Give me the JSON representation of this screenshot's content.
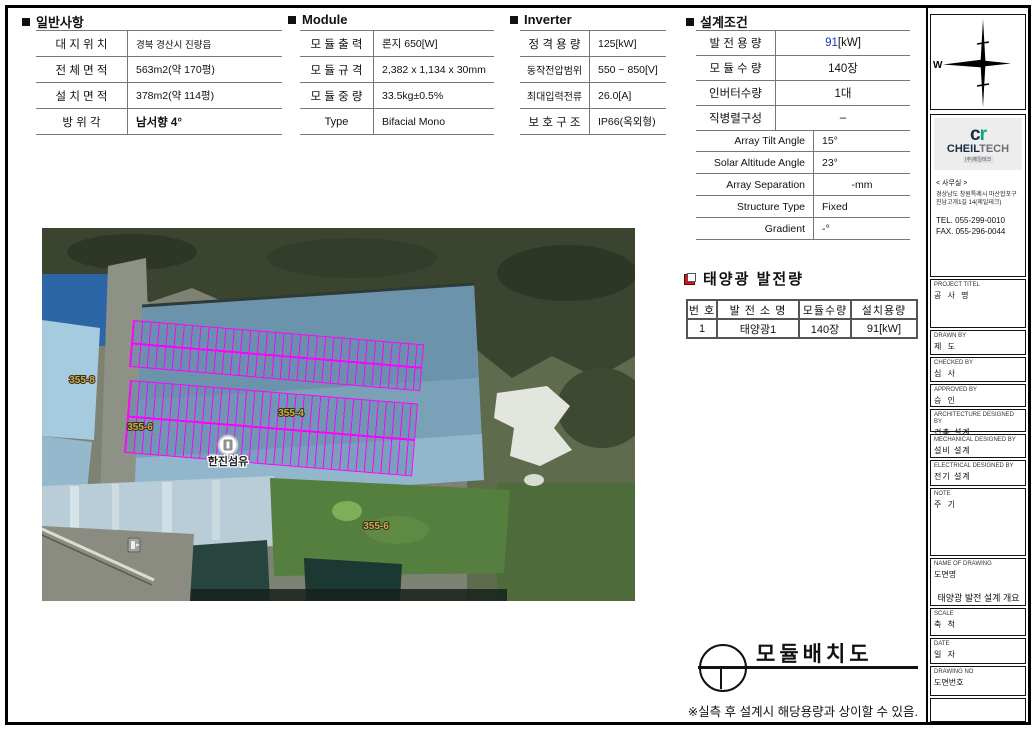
{
  "general": {
    "title": "일반사항",
    "rows": [
      {
        "label": "대 지 위 치",
        "value": "경북 경산시 진량읍"
      },
      {
        "label": "전 체 면 적",
        "value": "563m2(약 170평)"
      },
      {
        "label": "설 치 면 적",
        "value": "378m2(약 114평)"
      },
      {
        "label": "방 위 각",
        "value": "남서향 4°"
      }
    ]
  },
  "module": {
    "title": "Module",
    "rows": [
      {
        "label": "모 듈 출 력",
        "value": "론지 650[W]"
      },
      {
        "label": "모 듈 규 격",
        "value": "2,382 x 1,134 x 30mm"
      },
      {
        "label": "모 듈 중 량",
        "value": "33.5kg±0.5%"
      },
      {
        "label": "Type",
        "value": "Bifacial Mono"
      }
    ]
  },
  "inverter": {
    "title": "Inverter",
    "rows": [
      {
        "label": "정 격 용 량",
        "value": "125[kW]"
      },
      {
        "label": "동작전압범위",
        "value": "550 ~ 850[V]"
      },
      {
        "label": "최대입력전류",
        "value": "26.0[A]"
      },
      {
        "label": "보 호 구 조",
        "value": "IP66(옥외형)"
      }
    ]
  },
  "design": {
    "title": "설계조건",
    "rows_kr": [
      {
        "label": "발 전 용 량",
        "value_primary": "91",
        "value_suffix": "[kW]",
        "primary_color": "#1436c8"
      },
      {
        "label": "모 듈 수 량",
        "value": "140장"
      },
      {
        "label": "인버터수량",
        "value": "1대"
      },
      {
        "label": "직병렬구성",
        "value": "–"
      }
    ],
    "rows_en": [
      {
        "label": "Array Tilt Angle",
        "value": "15°"
      },
      {
        "label": "Solar Altitude Angle",
        "value": "23°"
      },
      {
        "label": "Array Separation",
        "value": "-mm"
      },
      {
        "label": "Structure Type",
        "value": "Fixed"
      },
      {
        "label": "Gradient",
        "value": "-°"
      }
    ]
  },
  "generation": {
    "title": "태양광 발전량",
    "headers": [
      "번 호",
      "발 전 소 명",
      "모듈수량",
      "설치용량"
    ],
    "rows": [
      [
        "1",
        "태양광1",
        "140장",
        "91[kW]"
      ]
    ]
  },
  "map": {
    "parcel_labels": [
      {
        "text": "355-8"
      },
      {
        "text": "355-6"
      },
      {
        "text": "355-4"
      },
      {
        "text": "355-6"
      }
    ],
    "poi_label": "한진섬유",
    "arrays": {
      "count": 2,
      "rows_per_array": 2,
      "cols_per_array": 35,
      "total_modules": 140,
      "outline_color": "#ff00ff"
    }
  },
  "bottom": {
    "drawing_title": "모듈배치도",
    "footnote": "※실측 후 설계시 해당용량과 상이할 수 있음."
  },
  "sidebar": {
    "compass_west": "W",
    "company": {
      "logo_c": "c",
      "logo_r": "r",
      "name_cheil": "CHEIL",
      "name_tech": "TECH",
      "sub": "(주)제일테크",
      "office": "< 사무실 >",
      "addr1": "경상남도 창원특례시 마산합포구",
      "addr2": "진남고개1길 14(제일테크)",
      "tel": "TEL. 055-299-0010",
      "fax": "FAX. 055-296-0044"
    },
    "fields": [
      {
        "en": "PROJECT TITEL",
        "kr": "공 사 명"
      },
      {
        "en": "DRAWN BY",
        "kr": "제  도"
      },
      {
        "en": "CHECKED BY",
        "kr": "심  사"
      },
      {
        "en": "APPROVED BY",
        "kr": "승  인"
      },
      {
        "en": "ARCHITECTURE DESIGNED BY",
        "kr": "건축 설계"
      },
      {
        "en": "MECHANICAL DESIGNED BY",
        "kr": "설비 설계"
      },
      {
        "en": "ELECTRICAL DESIGNED BY",
        "kr": "전기 설계"
      },
      {
        "en": "NOTE",
        "kr": "주  기"
      },
      {
        "en": "NAME OF DRAWING",
        "kr": "도면명",
        "value": "태양광 발전 설계 개요"
      },
      {
        "en": "SCALE",
        "kr": "축  척"
      },
      {
        "en": "DATE",
        "kr": "일  자"
      },
      {
        "en": "DRAWING NO",
        "kr": "도면번호"
      }
    ]
  }
}
